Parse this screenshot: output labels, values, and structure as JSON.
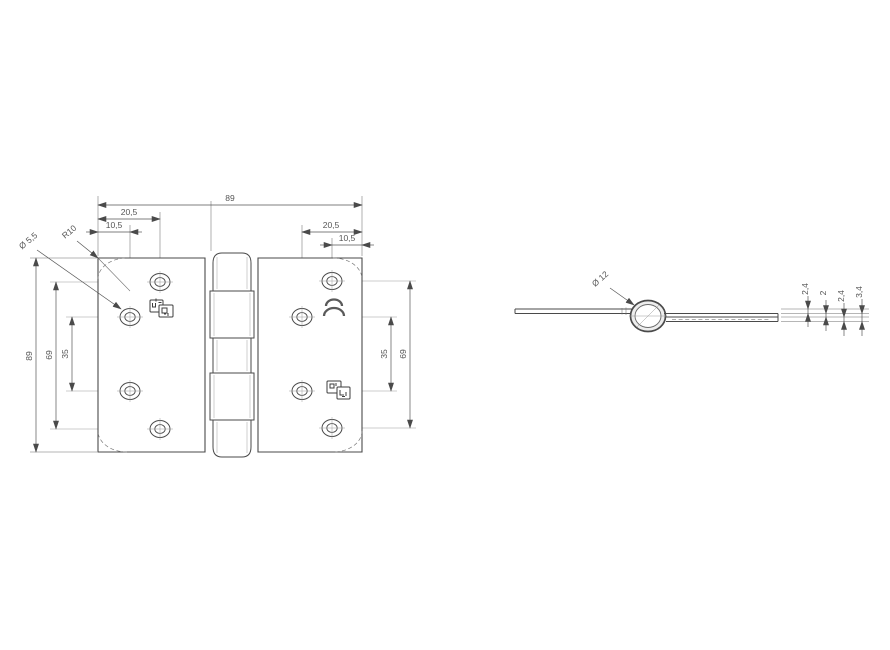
{
  "page": {
    "background": "#ffffff",
    "line_color": "#4a4a4a",
    "text_color": "#555555"
  },
  "front_view": {
    "dims": {
      "overall_width": "89",
      "overall_height": "89",
      "left_top_offset_outer": "20,5",
      "left_top_offset_inner": "10,5",
      "right_top_offset_outer": "20,5",
      "right_top_offset_inner": "10,5",
      "left_hole_span_outer": "69",
      "left_hole_span_inner": "35",
      "right_hole_span_inner": "35",
      "right_hole_span_outer": "69",
      "hole_diameter": "Ø 5,5",
      "corner_radius": "R10"
    },
    "icons": {
      "left_leaf_stamp": "certification-stamp-icon",
      "right_leaf_stamp": "certification-stamp-icon",
      "right_leaf_mark": "double-arc-logo-icon"
    }
  },
  "side_view": {
    "dims": {
      "knuckle_diameter": "Ø 12",
      "thickness_1": "2,4",
      "thickness_2": "2",
      "thickness_3": "2,4",
      "thickness_4": "3,4"
    }
  }
}
